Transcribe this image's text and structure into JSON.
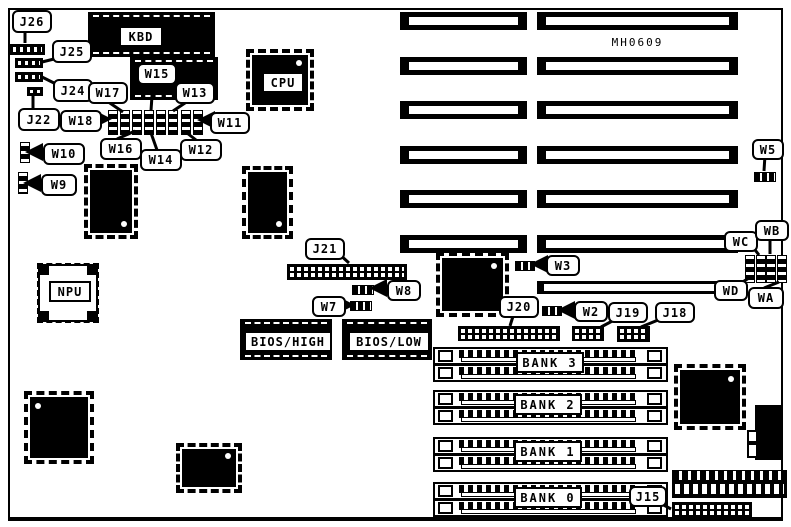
{
  "board": {
    "part_number": "MH0609"
  },
  "colors": {
    "ink": "#000000",
    "paper": "#ffffff"
  },
  "chips": {
    "kbd": "KBD",
    "cpu": "CPU",
    "npu": "NPU",
    "bios_high": "BIOS/HIGH",
    "bios_low": "BIOS/LOW"
  },
  "memory_banks": {
    "bank3": "BANK 3",
    "bank2": "BANK 2",
    "bank1": "BANK 1",
    "bank0": "BANK 0"
  },
  "jumpers": {
    "j26": "J26",
    "j25": "J25",
    "j24": "J24",
    "j22": "J22",
    "j21": "J21",
    "j20": "J20",
    "j19": "J19",
    "j18": "J18",
    "j15": "J15",
    "w18": "W18",
    "w17": "W17",
    "w16": "W16",
    "w15": "W15",
    "w14": "W14",
    "w13": "W13",
    "w12": "W12",
    "w11": "W11",
    "w10": "W10",
    "w9": "W9",
    "w8": "W8",
    "w7": "W7",
    "w5": "W5",
    "w3": "W3",
    "w2": "W2",
    "wa": "WA",
    "wb": "WB",
    "wc": "WC",
    "wd": "WD"
  }
}
